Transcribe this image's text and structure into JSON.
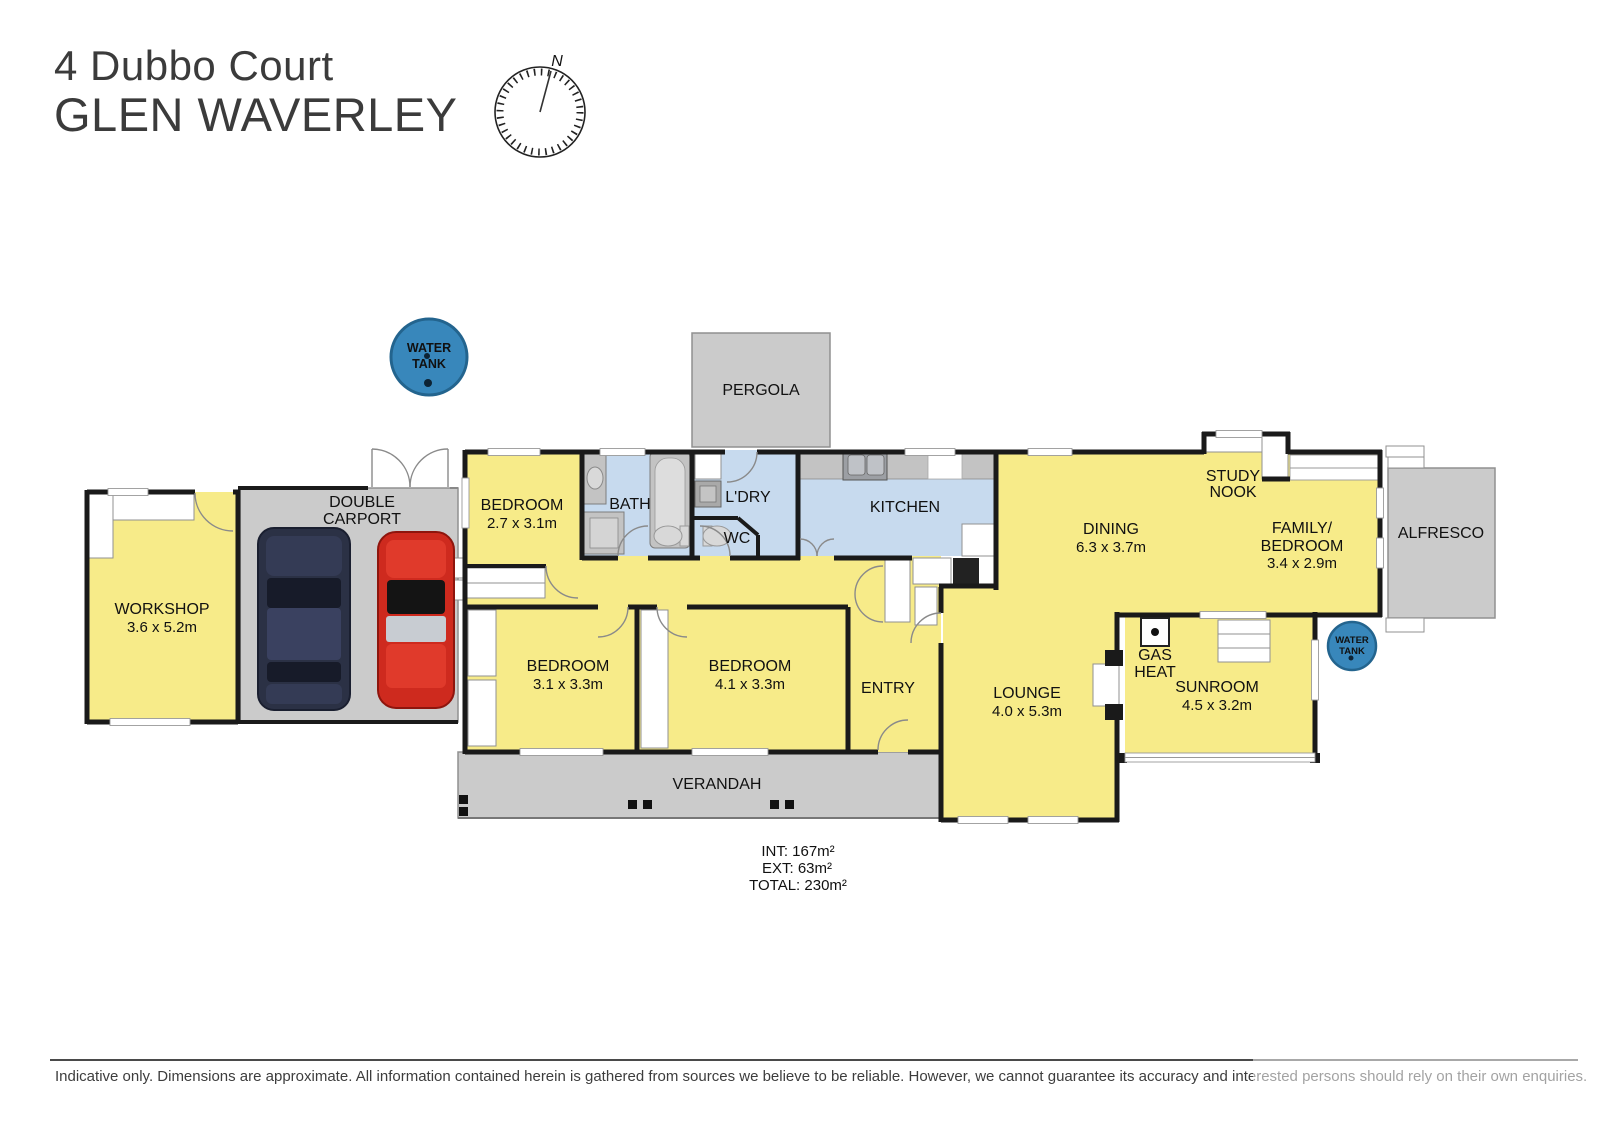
{
  "title": {
    "line1": "4 Dubbo Court",
    "line2": "GLEN WAVERLEY"
  },
  "compass": {
    "north": "N"
  },
  "plan": {
    "workshop": {
      "name": "WORKSHOP",
      "dims": "3.6 x 5.2m"
    },
    "carport": {
      "line1": "DOUBLE",
      "line2": "CARPORT"
    },
    "pergola": {
      "name": "PERGOLA"
    },
    "water_tank": {
      "line1": "WATER",
      "line2": "TANK"
    },
    "bedroom_a": {
      "name": "BEDROOM",
      "dims": "2.7 x 3.1m"
    },
    "bath": {
      "name": "BATH"
    },
    "laundry": {
      "name": "L'DRY"
    },
    "wc": {
      "name": "WC"
    },
    "kitchen": {
      "name": "KITCHEN"
    },
    "dining": {
      "name": "DINING",
      "dims": "6.3 x 3.7m"
    },
    "study_nook": {
      "line1": "STUDY",
      "line2": "NOOK"
    },
    "family": {
      "line1": "FAMILY/",
      "line2": "BEDROOM",
      "dims": "3.4 x 2.9m"
    },
    "alfresco": {
      "name": "ALFRESCO"
    },
    "bedroom_b": {
      "name": "BEDROOM",
      "dims": "3.1 x 3.3m"
    },
    "bedroom_c": {
      "name": "BEDROOM",
      "dims": "4.1 x 3.3m"
    },
    "entry": {
      "name": "ENTRY"
    },
    "lounge": {
      "name": "LOUNGE",
      "dims": "4.0 x 5.3m"
    },
    "gas_heat": {
      "line1": "GAS",
      "line2": "HEAT"
    },
    "sunroom": {
      "name": "SUNROOM",
      "dims": "4.5 x 3.2m"
    },
    "verandah": {
      "name": "VERANDAH"
    }
  },
  "areas": {
    "int": "INT: 167m²",
    "ext": "EXT: 63m²",
    "total": "TOTAL: 230m²"
  },
  "footer": {
    "disclaimer": "Indicative only. Dimensions are approximate. All information contained herein is gathered from sources we believe to be reliable. However, we cannot guarantee its accuracy and interested persons should rely on their own enquiries."
  },
  "colors": {
    "room_yellow": "#F7EB89",
    "wet_blue": "#C7DAEE",
    "outdoor_grey": "#CBCBCB",
    "wall": "#1A1A1A",
    "tank_blue": "#3887BB",
    "car_dark": "#2B3145",
    "car_red": "#CE2A1E"
  }
}
